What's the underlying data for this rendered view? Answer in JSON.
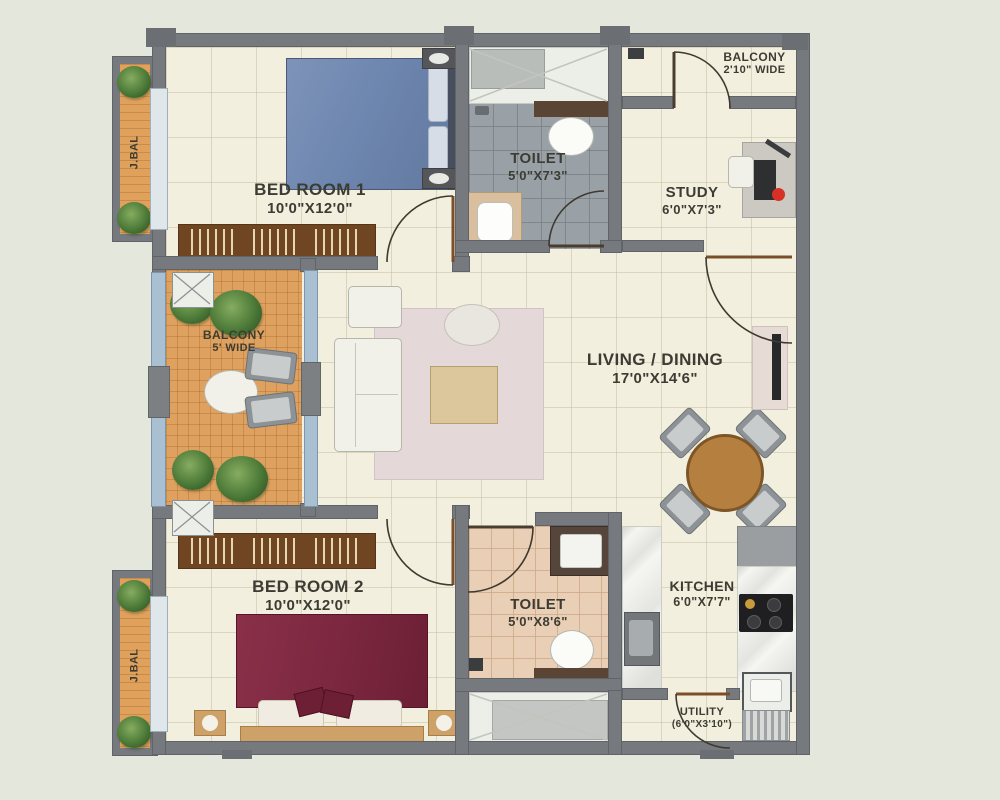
{
  "rooms": {
    "bedroom1": {
      "name": "BED ROOM 1",
      "dims": "10'0\"X12'0\""
    },
    "toilet1": {
      "name": "TOILET",
      "dims": "5'0\"X7'3\""
    },
    "study": {
      "name": "STUDY",
      "dims": "6'0\"X7'3\""
    },
    "balcony_top": {
      "name": "BALCONY",
      "dims": "2'10\" WIDE"
    },
    "balcony_left": {
      "name": "BALCONY",
      "dims": "5' WIDE"
    },
    "living": {
      "name": "LIVING / DINING",
      "dims": "17'0\"X14'6\""
    },
    "bedroom2": {
      "name": "BED ROOM 2",
      "dims": "10'0\"X12'0\""
    },
    "toilet2": {
      "name": "TOILET",
      "dims": "5'0\"X8'6\""
    },
    "kitchen": {
      "name": "KITCHEN",
      "dims": "6'0\"X7'7\""
    },
    "utility": {
      "name": "UTILITY",
      "dims": "(6'0\"X3'10\")"
    },
    "jbal_top": {
      "name": "J.BAL"
    },
    "jbal_bottom": {
      "name": "J.BAL"
    }
  },
  "colors": {
    "background": "#e3e7dc",
    "wall": "#76797d",
    "floor": "#f2efdf",
    "balcony_floor": "#dfa15f",
    "toilet1_floor": "#9aa1a6",
    "toilet2_floor": "#e9cfb6",
    "bed1": "#6e87b0",
    "bed2": "#7c2840",
    "wood": "#b5803f",
    "rug": "#e4d8d8",
    "label_text": "#3c3c33"
  }
}
